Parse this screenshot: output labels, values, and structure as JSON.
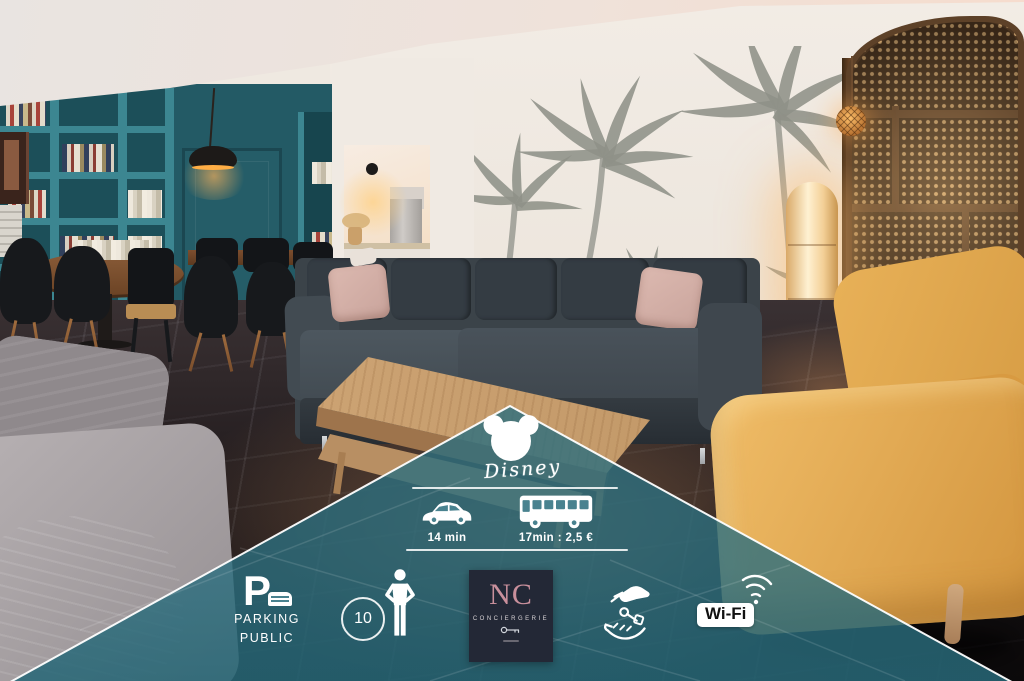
{
  "scene": {
    "description_colors": {
      "shelf_teal": "#3c8691",
      "wall_teal": "#235a65",
      "sofa_charcoal": "#3b4349",
      "couch_yellow": "#e3aa52",
      "wood_screen_brown": "#5d4128"
    }
  },
  "overlay": {
    "colors": {
      "panel_teal": "#2c6e7e",
      "edge_white": "#ffffff",
      "concierge_bg": "#232836",
      "concierge_monogram": "#c9909c",
      "wifi_text": "#111111"
    },
    "disney": {
      "icon": "mickey-ears-icon",
      "brand": "Disney"
    },
    "travel": [
      {
        "icon": "car-icon",
        "label": "14 min"
      },
      {
        "icon": "bus-icon",
        "label": "17min : 2,5 €"
      }
    ],
    "parking": {
      "letter": "P",
      "icon": "parking-car-icon",
      "line1": "PARKING",
      "line2": "PUBLIC"
    },
    "capacity": {
      "count": "10",
      "icon": "person-icon"
    },
    "concierge": {
      "monogram": "NC",
      "name": "CONCIERGERIE",
      "icon": "key-icon"
    },
    "handover": {
      "icon": "key-handover-icon"
    },
    "wifi": {
      "label": "Wi-Fi",
      "icon": "wifi-signal-icon"
    }
  }
}
